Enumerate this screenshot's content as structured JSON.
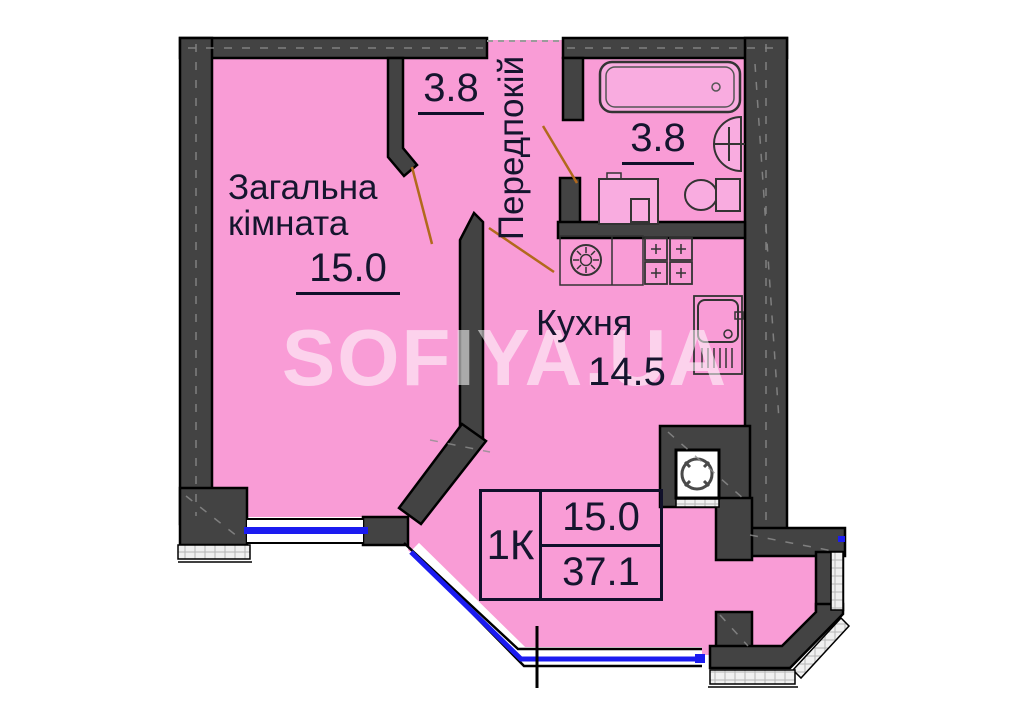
{
  "type": "apartment-floor-plan",
  "watermark": {
    "text": "SOFIYA.UA"
  },
  "rooms": {
    "living": {
      "name_line1": "Загальна",
      "name_line2": "кімната",
      "area": "15.0"
    },
    "closet": {
      "area": "3.8"
    },
    "hallway": {
      "name": "Передпокій"
    },
    "bathroom": {
      "area": "3.8"
    },
    "kitchen": {
      "name": "Кухня",
      "area": "14.5"
    }
  },
  "summary": {
    "unit_type": "1К",
    "living_area": "15.0",
    "total_area": "37.1"
  },
  "fixtures": [
    "bathtub",
    "bath-sink",
    "toilet",
    "washing-machine",
    "kitchen-hood-counter",
    "stove",
    "kitchen-sink",
    "ventilation-shaft"
  ],
  "colors": {
    "room_fill": "#f99cd6",
    "fixture_fill": "#f9ace0",
    "wall_fill": "#434343",
    "wall_outline": "#000000",
    "window_glass": "#1b1bf0",
    "leader_line": "#b2691c",
    "label_text": "#15152e",
    "watermark_text": "rgba(255,255,255,0.55)"
  }
}
